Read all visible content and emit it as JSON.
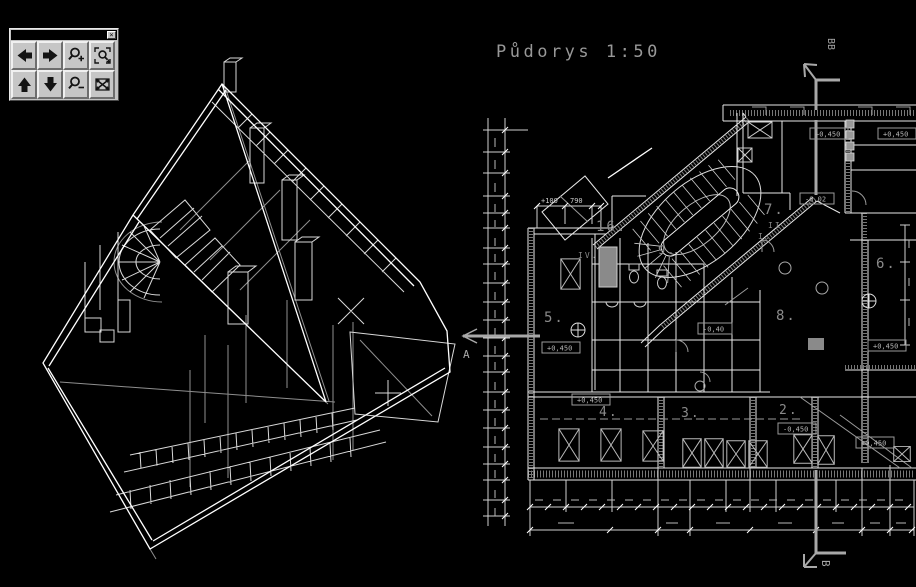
{
  "toolbar": {
    "close_glyph": "×",
    "buttons": [
      {
        "name": "pan-left",
        "icon": "arrow-left-icon"
      },
      {
        "name": "pan-right",
        "icon": "arrow-right-icon"
      },
      {
        "name": "zoom-in",
        "icon": "magnifier-plus-icon"
      },
      {
        "name": "zoom-window",
        "icon": "magnifier-window-icon"
      },
      {
        "name": "pan-up",
        "icon": "arrow-up-icon"
      },
      {
        "name": "pan-down",
        "icon": "arrow-down-icon"
      },
      {
        "name": "zoom-out",
        "icon": "magnifier-minus-icon"
      },
      {
        "name": "zoom-extents",
        "icon": "zoom-extents-icon"
      }
    ]
  },
  "plan": {
    "title": "Půdorys   1:50",
    "sections": {
      "left": "A",
      "bottom": "B",
      "top": "BB"
    },
    "rooms": [
      {
        "label": "16."
      },
      {
        "label": "5."
      },
      {
        "label": "9."
      },
      {
        "label": "7."
      },
      {
        "label": "6."
      },
      {
        "label": "8."
      },
      {
        "label": "4."
      },
      {
        "label": "3."
      },
      {
        "label": "2."
      },
      {
        "label": "IV."
      },
      {
        "label": "I."
      },
      {
        "label": "II."
      }
    ],
    "elevations": [
      "+0,450",
      "+0,450",
      "-0,02",
      "+0,450",
      "+0,450",
      "-0,40",
      "+0,450",
      "-0,450",
      "+0,450"
    ],
    "dims": [
      "+100",
      "790"
    ],
    "colors": {
      "background": "#000000",
      "line": "#e8e8e8",
      "annotation": "#9a9a9a",
      "section_arrow": "#a8a8a8"
    }
  }
}
